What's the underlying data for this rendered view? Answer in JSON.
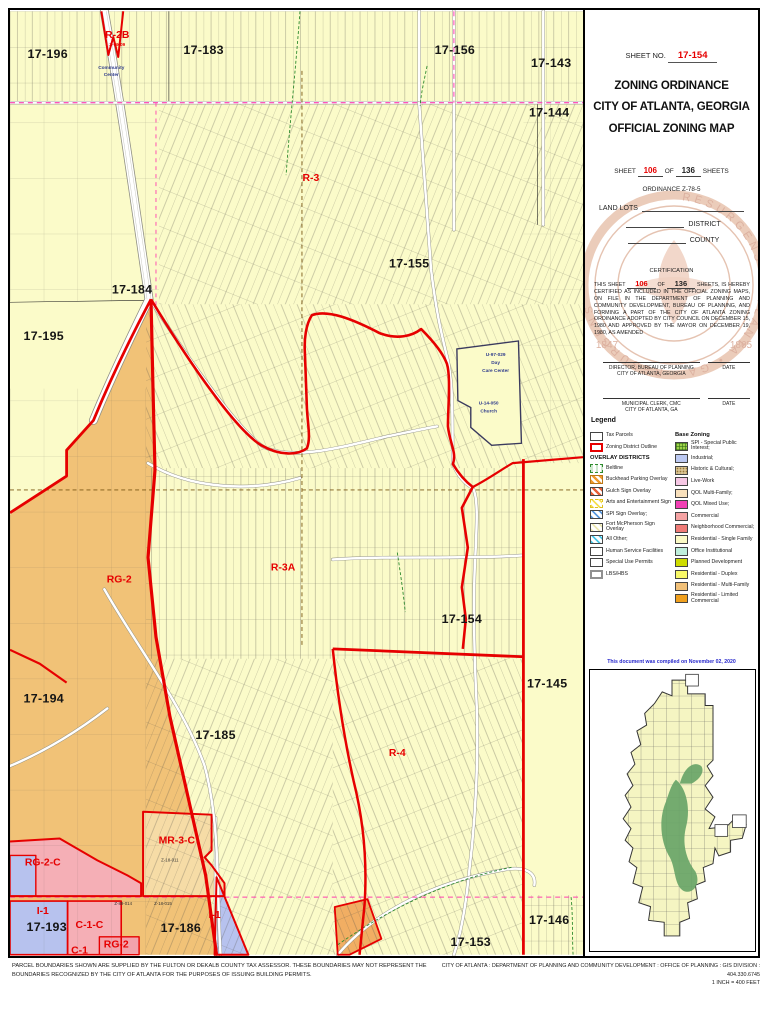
{
  "header": {
    "sheet_no_label": "SHEET NO.",
    "sheet_no_value": "17-154",
    "title_line1": "ZONING ORDINANCE",
    "title_line2": "CITY OF ATLANTA, GEORGIA",
    "title_line3": "OFFICIAL ZONING MAP",
    "sheet_label": "SHEET",
    "sheet_current": "106",
    "of_label": "OF",
    "sheet_total": "136",
    "sheets_label": "SHEETS",
    "ordinance": "ORDINANCE Z-78-5",
    "land_lots_label": "LAND LOTS",
    "district_label": "DISTRICT",
    "county_label": "COUNTY"
  },
  "certification": {
    "heading": "CERTIFICATION",
    "body_pre": "THIS SHEET",
    "body_of": "OF",
    "body_post": "SHEETS, IS HEREBY CERTIFIED AS INCLUDED IN THE OFFICIAL ZONING MAPS, ON FILE IN THE DEPARTMENT OF PLANNING AND COMMUNITY DEVELOPMENT, BUREAU OF PLANNING, AND FORMING A PART OF THE CITY OF ATLANTA ZONING ORDINANCE ADOPTED BY CITY COUNCIL ON DECEMBER 15, 1980 AND APPROVED BY THE MAYOR ON DECEMBER 19, 1980, AS AMENDED",
    "sig1_line1": "DIRECTOR, BUREAU OF PLANNING",
    "sig1_line2": "CITY OF ATLANTA, GEORGIA",
    "sig1_date": "DATE",
    "sig2_line1": "MUNICIPAL CLERK, CMC",
    "sig2_line2": "CITY OF ATLANTA, GA",
    "sig2_date": "DATE"
  },
  "seal": {
    "arc_text": "RESURGENS • ATLANTA • GA • RESURGENS",
    "year_left": "1847",
    "year_right": "1865"
  },
  "legend": {
    "title": "Legend",
    "items_top": [
      {
        "label": "Tax Parcels",
        "swatch": ""
      },
      {
        "label": "Zoning District Outline",
        "swatch": "sw-redline"
      }
    ],
    "overlay_heading": "OVERLAY DISTRICTS",
    "overlay_items": [
      {
        "label": "Beltline",
        "swatch": "sw-belt"
      },
      {
        "label": "Buckhead Parking Overlay",
        "swatch": "sw-x-orange"
      },
      {
        "label": "Gulch Sign Overlay",
        "swatch": "sw-x-gulch"
      },
      {
        "label": "Arts and Entertainment Sign",
        "swatch": "sw-x-arts"
      },
      {
        "label": "SPI Sign Overlay;",
        "swatch": "sw-x-blue"
      },
      {
        "label": "Fort McPherson Sign Overlay",
        "swatch": "sw-x-fort"
      },
      {
        "label": "All Other;",
        "swatch": "sw-x-cyan"
      },
      {
        "label": "Human Service Facilities",
        "swatch": ""
      },
      {
        "label": "Special Use Permits",
        "swatch": ""
      },
      {
        "label": "LBS/HBS",
        "swatch": "sw-lbs"
      }
    ],
    "base_heading": "Base Zoning",
    "base_items": [
      {
        "label": "SPI - Special Public Interest;",
        "color": "#9FD34A",
        "fx": "sw-grid"
      },
      {
        "label": "Industrial;",
        "color": "#BCC9F2",
        "fx": ""
      },
      {
        "label": "Historic & Cultural;",
        "color": "#D9C391",
        "fx": "sw-dots"
      },
      {
        "label": "Live-Work",
        "color": "#F6C7E4",
        "fx": ""
      },
      {
        "label": "QOL Multi-Family;",
        "color": "#F8E0BC",
        "fx": ""
      },
      {
        "label": "QOL Mixed Use;",
        "color": "#F23FB4",
        "fx": ""
      },
      {
        "label": "Commercial",
        "color": "#F5A3A3",
        "fx": ""
      },
      {
        "label": "Neighborhood Commercial;",
        "color": "#EF7B77",
        "fx": ""
      },
      {
        "label": "Residential - Single Family",
        "color": "#FBFAC5",
        "fx": ""
      },
      {
        "label": "Office Institutional",
        "color": "#BFEFDC",
        "fx": ""
      },
      {
        "label": "Planned Development",
        "color": "#CEDC00",
        "fx": ""
      },
      {
        "label": "Residential - Duplex",
        "color": "#F8F868",
        "fx": ""
      },
      {
        "label": "Residential - Multi-Family",
        "color": "#F1C078",
        "fx": ""
      },
      {
        "label": "Residential - Limited Commercial",
        "color": "#F0A01E",
        "fx": ""
      }
    ]
  },
  "compiled_note": "This document was compiled on November 02, 2020",
  "footer": {
    "left": "PARCEL BOUNDARIES SHOWN ARE SUPPLIED BY THE FULTON OR DEKALB COUNTY TAX ASSESSOR.  THESE BOUNDARIES MAY NOT REPRESENT THE BOUNDARIES RECOGNIZED BY THE CITY OF ATLANTA FOR THE PURPOSES OF ISSUING BUILDING PERMITS.",
    "right_line1": "CITY OF ATLANTA : DEPARTMENT OF PLANNING AND COMMUNITY DEVELOPMENT : OFFICE OF PLANNING : GIS DIVISION : 404.330.6745",
    "right_line2": "1 INCH = 400 FEET"
  },
  "colors": {
    "base_yellow": "#FBFBC9",
    "district_outline_red": "#E60000",
    "multi_family_orange": "#F1C277",
    "industrial_blue": "#B7C2EE",
    "commercial_pink": "#F5AFB6",
    "boundary_magenta": "#FF3FAE"
  },
  "map": {
    "labels": [
      {
        "t": "17-196",
        "x": 38,
        "y": 47,
        "cls": "d"
      },
      {
        "t": "17-183",
        "x": 195,
        "y": 43,
        "cls": "d"
      },
      {
        "t": "17-156",
        "x": 448,
        "y": 43,
        "cls": "d"
      },
      {
        "t": "17-143",
        "x": 545,
        "y": 56,
        "cls": "d"
      },
      {
        "t": "17-144",
        "x": 543,
        "y": 106,
        "cls": "d"
      },
      {
        "t": "17-155",
        "x": 402,
        "y": 258,
        "cls": "d"
      },
      {
        "t": "17-184",
        "x": 123,
        "y": 284,
        "cls": "d"
      },
      {
        "t": "17-195",
        "x": 34,
        "y": 331,
        "cls": "d"
      },
      {
        "t": "17-154",
        "x": 455,
        "y": 616,
        "cls": "d"
      },
      {
        "t": "17-145",
        "x": 541,
        "y": 681,
        "cls": "d"
      },
      {
        "t": "17-194",
        "x": 34,
        "y": 696,
        "cls": "d"
      },
      {
        "t": "17-185",
        "x": 207,
        "y": 733,
        "cls": "d"
      },
      {
        "t": "17-193",
        "x": 37,
        "y": 926,
        "cls": "d"
      },
      {
        "t": "17-186",
        "x": 172,
        "y": 927,
        "cls": "d"
      },
      {
        "t": "17-146",
        "x": 543,
        "y": 919,
        "cls": "d"
      },
      {
        "t": "17-153",
        "x": 464,
        "y": 941,
        "cls": "d"
      },
      {
        "t": "R-2B",
        "x": 108,
        "y": 27,
        "cls": "r"
      },
      {
        "t": "R-3",
        "x": 303,
        "y": 171,
        "cls": "r"
      },
      {
        "t": "RG-2",
        "x": 110,
        "y": 575,
        "cls": "r"
      },
      {
        "t": "R-3A",
        "x": 275,
        "y": 563,
        "cls": "r"
      },
      {
        "t": "R-4",
        "x": 390,
        "y": 750,
        "cls": "r"
      },
      {
        "t": "MR-3-C",
        "x": 168,
        "y": 838,
        "cls": "r"
      },
      {
        "t": "RG-2-C",
        "x": 33,
        "y": 860,
        "cls": "r"
      },
      {
        "t": "I-1",
        "x": 33,
        "y": 909,
        "cls": "r"
      },
      {
        "t": "C-1-C",
        "x": 80,
        "y": 923,
        "cls": "r"
      },
      {
        "t": "RG-2",
        "x": 107,
        "y": 943,
        "cls": "r"
      },
      {
        "t": "I-1",
        "x": 206,
        "y": 913,
        "cls": "r"
      },
      {
        "t": "C-1",
        "x": 70,
        "y": 949,
        "cls": "r"
      },
      {
        "t": "Z-09-09",
        "x": 108,
        "y": 35,
        "cls": "rs"
      },
      {
        "t": "Community",
        "x": 102,
        "y": 58,
        "cls": "b"
      },
      {
        "t": "Center",
        "x": 102,
        "y": 65,
        "cls": "b"
      },
      {
        "t": "U-97-029",
        "x": 489,
        "y": 347,
        "cls": "b"
      },
      {
        "t": "Day",
        "x": 489,
        "y": 355,
        "cls": "b"
      },
      {
        "t": "Care Center",
        "x": 489,
        "y": 363,
        "cls": "b"
      },
      {
        "t": "U-14-050",
        "x": 482,
        "y": 396,
        "cls": "b"
      },
      {
        "t": "Church",
        "x": 482,
        "y": 404,
        "cls": "b"
      },
      {
        "t": "Z-89-014",
        "x": 114,
        "y": 900,
        "cls": "k"
      },
      {
        "t": "Z-18-015",
        "x": 154,
        "y": 900,
        "cls": "k"
      },
      {
        "t": "Z-18-011",
        "x": 161,
        "y": 856,
        "cls": "k"
      }
    ]
  }
}
